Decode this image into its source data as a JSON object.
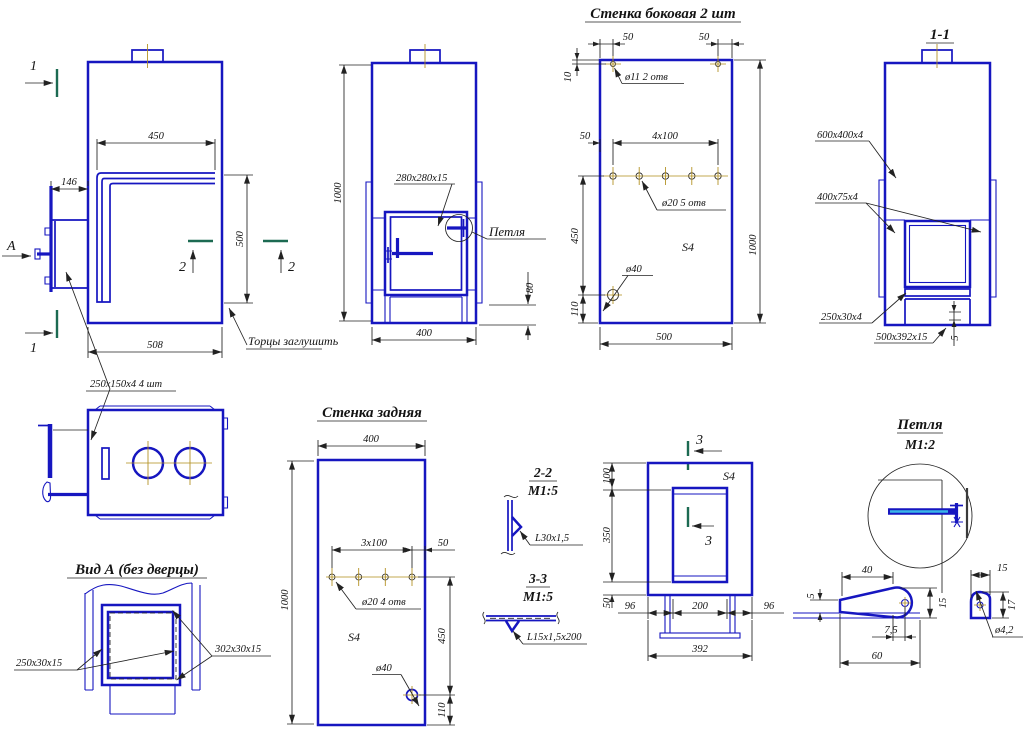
{
  "palette": {
    "blue_line": "#1616c0",
    "dim_line": "#222222",
    "centerline": "#b08d1a",
    "section_mark": "#1c6a52",
    "hinge_core": "#38b6e8",
    "background": "#ffffff"
  },
  "d": {
    "v1": {
      "sec1_top": "1",
      "sec1_bottom": "1",
      "view_arrow": "А",
      "sec2_left": "2",
      "sec2_right": "2",
      "dim_width_top": "450",
      "dim_door": "146",
      "dim_height_right": "500",
      "dim_width_bottom": "508",
      "note": "Торцы заглушить",
      "label_plates": "250х150х4 4 шт"
    },
    "v2": {
      "dim_height": "1000",
      "label_door": "280х280х15",
      "label_hinge": "Петля",
      "dim_80": "80",
      "dim_width": "400"
    },
    "v3": {
      "title": "Стенка боковая 2 шт",
      "dim_50_top_left": "50",
      "dim_50_top_right": "50",
      "dim_10": "10",
      "label_holes_11": "ø11 2 отв",
      "dim_50_row": "50",
      "dim_row": "4х100",
      "label_holes_20": "ø20 5 отв",
      "thickness": "S4",
      "label_hole_40": "ø40",
      "dim_450": "450",
      "dim_110": "110",
      "dim_height": "1000",
      "dim_width": "500"
    },
    "v4": {
      "title": "1-1",
      "label_body": "600х400х4",
      "label_channel": "400х75х4",
      "label_plate": "250х30х4",
      "label_base": "500х392х15",
      "dim_5": "5"
    },
    "v6": {
      "title": "Вид А (без дверцы)",
      "label_vertical": "250х30х15",
      "label_horizontal": "302х30х15"
    },
    "v7": {
      "title": "Стенка задняя",
      "dim_width": "400",
      "dim_height": "1000",
      "dim_row": "3х100",
      "dim_50": "50",
      "label_holes_20": "ø20 4 отв",
      "thickness": "S4",
      "label_hole_40": "ø40",
      "dim_450": "450",
      "dim_110": "110"
    },
    "v8": {
      "sec22_title": "2-2",
      "sec22_scale": "М1:5",
      "sec22_label": "L30х1,5",
      "sec33_title": "3-3",
      "sec33_scale": "М1:5",
      "sec33_label": "L15х1,5х200"
    },
    "v9": {
      "sec3_top": "3",
      "sec3_inner": "3",
      "thickness": "S4",
      "dim_100": "100",
      "dim_350": "350",
      "dim_50": "50",
      "dim_96_left": "96",
      "dim_200": "200",
      "dim_96_right": "96",
      "dim_392": "392"
    },
    "v10": {
      "title": "Петля",
      "scale": "М1:2",
      "dim_40": "40",
      "dim_5": "5",
      "dim_15": "15",
      "dim_7_5": "7,5",
      "dim_60": "60",
      "dim_15_knuckle": "15",
      "dim_17": "17",
      "label_hole": "ø4,2"
    }
  }
}
